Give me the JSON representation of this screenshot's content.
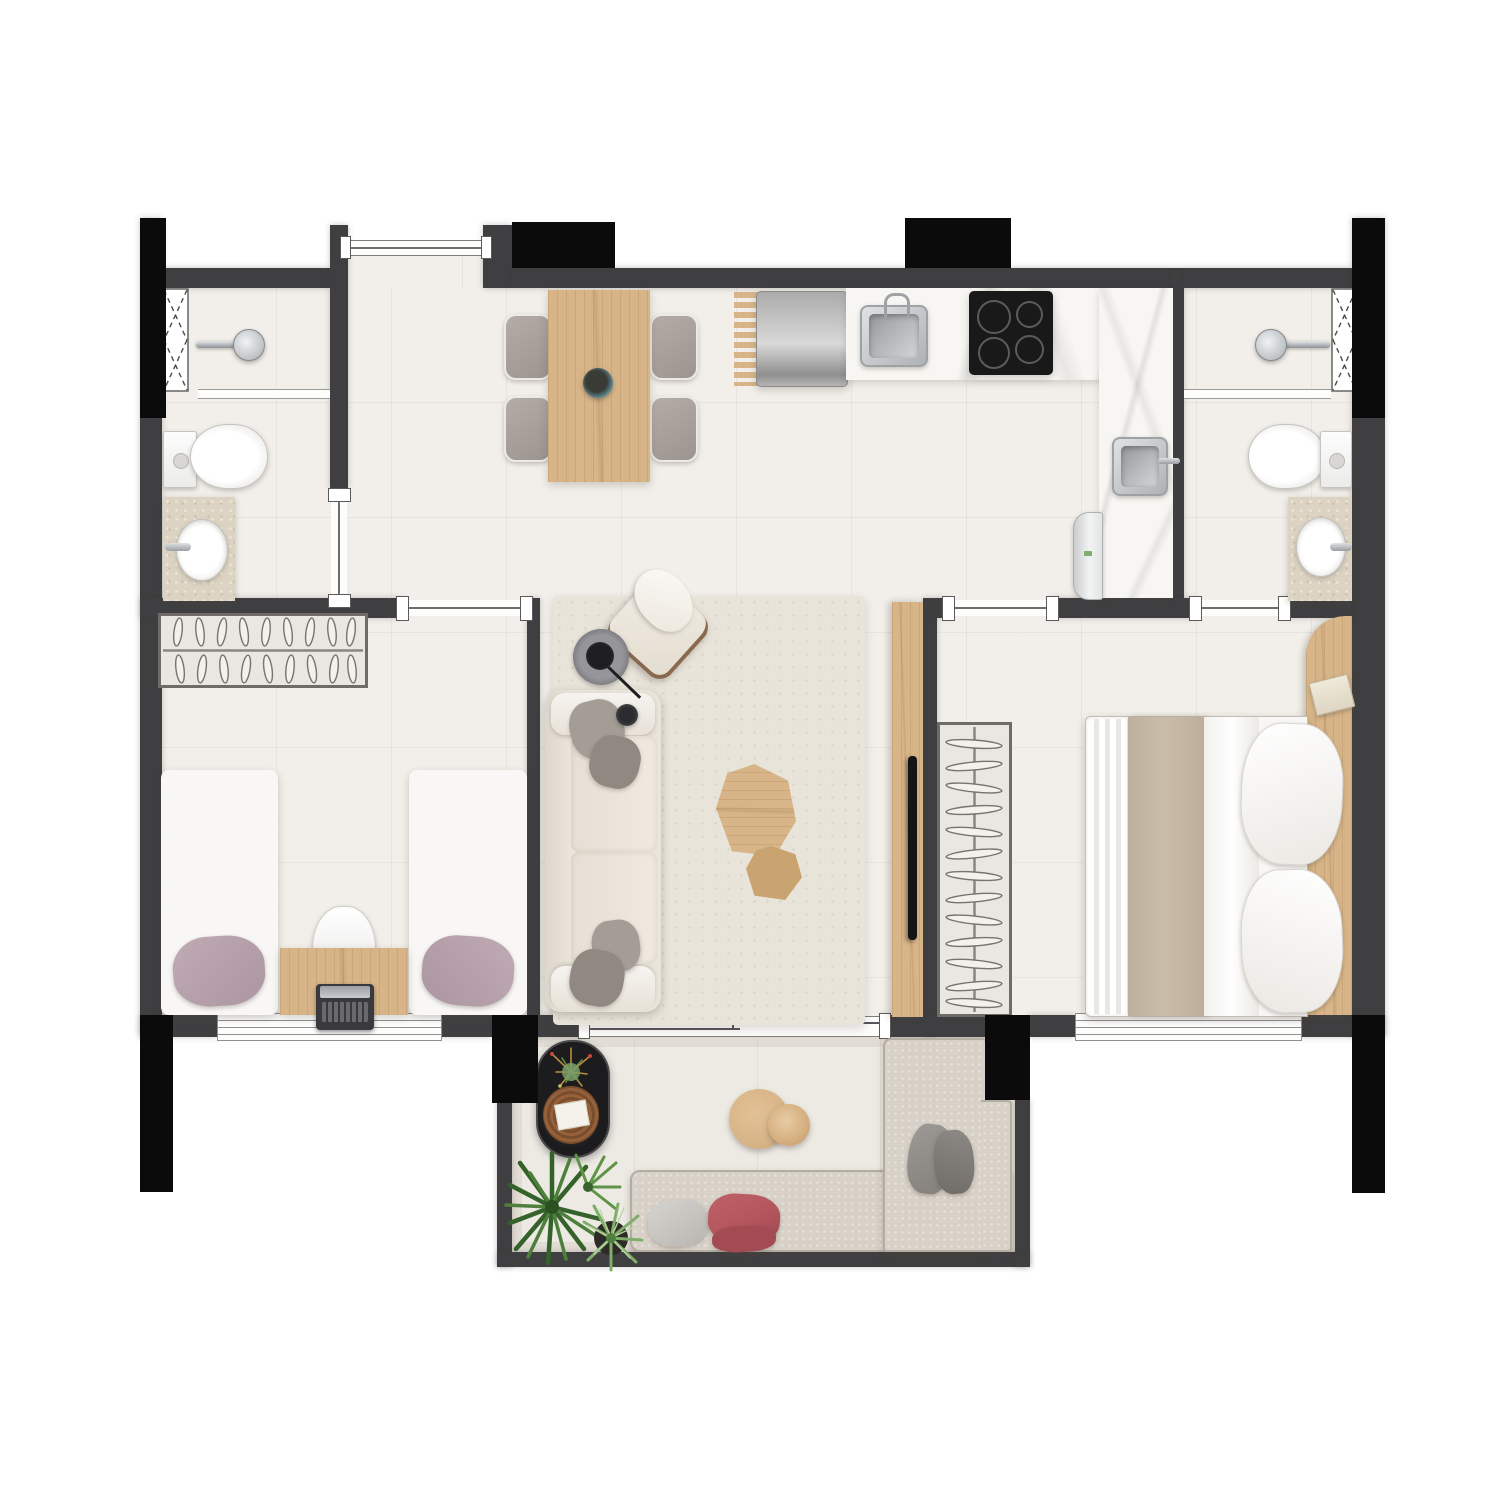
{
  "title": "Rendered apartment floor plan: two bedrooms, two bathrooms, open kitchen and living-dining room, laundry corner and furnished balcony",
  "colors": {
    "wall": "#3f3f41",
    "column": "#0b0b0b",
    "floor": "#f2efea",
    "balcony-floor": "#edeae4",
    "wood": "#d8b588",
    "wood-dark": "#c9a471",
    "marble": "#f7f6f2",
    "counter-beige": "#ddd3c2",
    "chair-gray": "#a8a099",
    "mauve": "#b0a3ad",
    "mauve-light": "#c0abb4",
    "white-soft": "#f8f7f5",
    "cream": "#eae4da",
    "cream-dark": "#ddd6ca",
    "pillow-gray": "#a39d95",
    "pillow-gray-dark": "#8f8982",
    "taupe": "#c9bca9",
    "rug": "#e8e4da",
    "outdoor-sofa": "#d8d1c7",
    "red-pillow": "#b2545c",
    "plant": "#3c6b33",
    "plant-light": "#6fa05a",
    "steel": "#c3c7ca",
    "black-item": "#232326"
  },
  "structure": {
    "black_columns": 8,
    "louver_windows": 2,
    "striped_windows": 2,
    "sliding_doors": [
      "bedroom-1",
      "bedroom-2",
      "bathroom-2-ensuite",
      "balcony"
    ],
    "swing_doors": [
      "entry",
      "bathroom-1"
    ]
  },
  "rooms": [
    {
      "id": "entry",
      "name": "recessed entry",
      "furniture": [
        "entry door"
      ]
    },
    {
      "id": "bathroom-1",
      "name": "bathroom left",
      "furniture": [
        "walk-in shower",
        "shower head",
        "glass screen",
        "louver window",
        "toilet",
        "vanity with oval basin",
        "swing door"
      ]
    },
    {
      "id": "kitchen-dining",
      "name": "open kitchen and dining",
      "furniture": [
        "dining table for four",
        "4 upholstered chairs",
        "teal decor bowl",
        "wood trivet rack",
        "refrigerator",
        "L-shaped stone countertop",
        "inset steel sink with tap",
        "4-zone cooktop",
        "laundry tank sink",
        "washing machine"
      ]
    },
    {
      "id": "bedroom-1",
      "name": "twin bedroom",
      "furniture": [
        "double-rail wardrobe with hangers",
        "twin bed left",
        "twin bed right",
        "desk",
        "desk chair",
        "laptop",
        "sliding door",
        "striped window"
      ]
    },
    {
      "id": "living",
      "name": "living room",
      "furniture": [
        "area rug",
        "three-seat sofa",
        "4 gray pillows",
        "rotated lounge armchair",
        "arc floor lamp",
        "organic coffee table large",
        "organic coffee table small",
        "wood tv panel",
        "wall tv"
      ]
    },
    {
      "id": "bedroom-2",
      "name": "master bedroom",
      "furniture": [
        "open wardrobe with hangers",
        "double bed",
        "taupe runner blanket",
        "white duvet",
        "4 white pillows",
        "curved wood headboard panel",
        "book",
        "sliding door",
        "striped window"
      ]
    },
    {
      "id": "bathroom-2",
      "name": "en-suite bathroom right",
      "furniture": [
        "walk-in shower",
        "shower head",
        "glass screen",
        "louver window",
        "toilet",
        "vanity with oval basin",
        "sliding door"
      ]
    },
    {
      "id": "balcony",
      "name": "balcony terrace",
      "furniture": [
        "L-shaped outdoor sofa",
        "gray pillows",
        "red pillows",
        "round side table large",
        "round side table small",
        "black oval plant stand",
        "woven tray with card",
        "potted palm",
        "striped-leaf plant",
        "sliding glass door"
      ]
    }
  ]
}
